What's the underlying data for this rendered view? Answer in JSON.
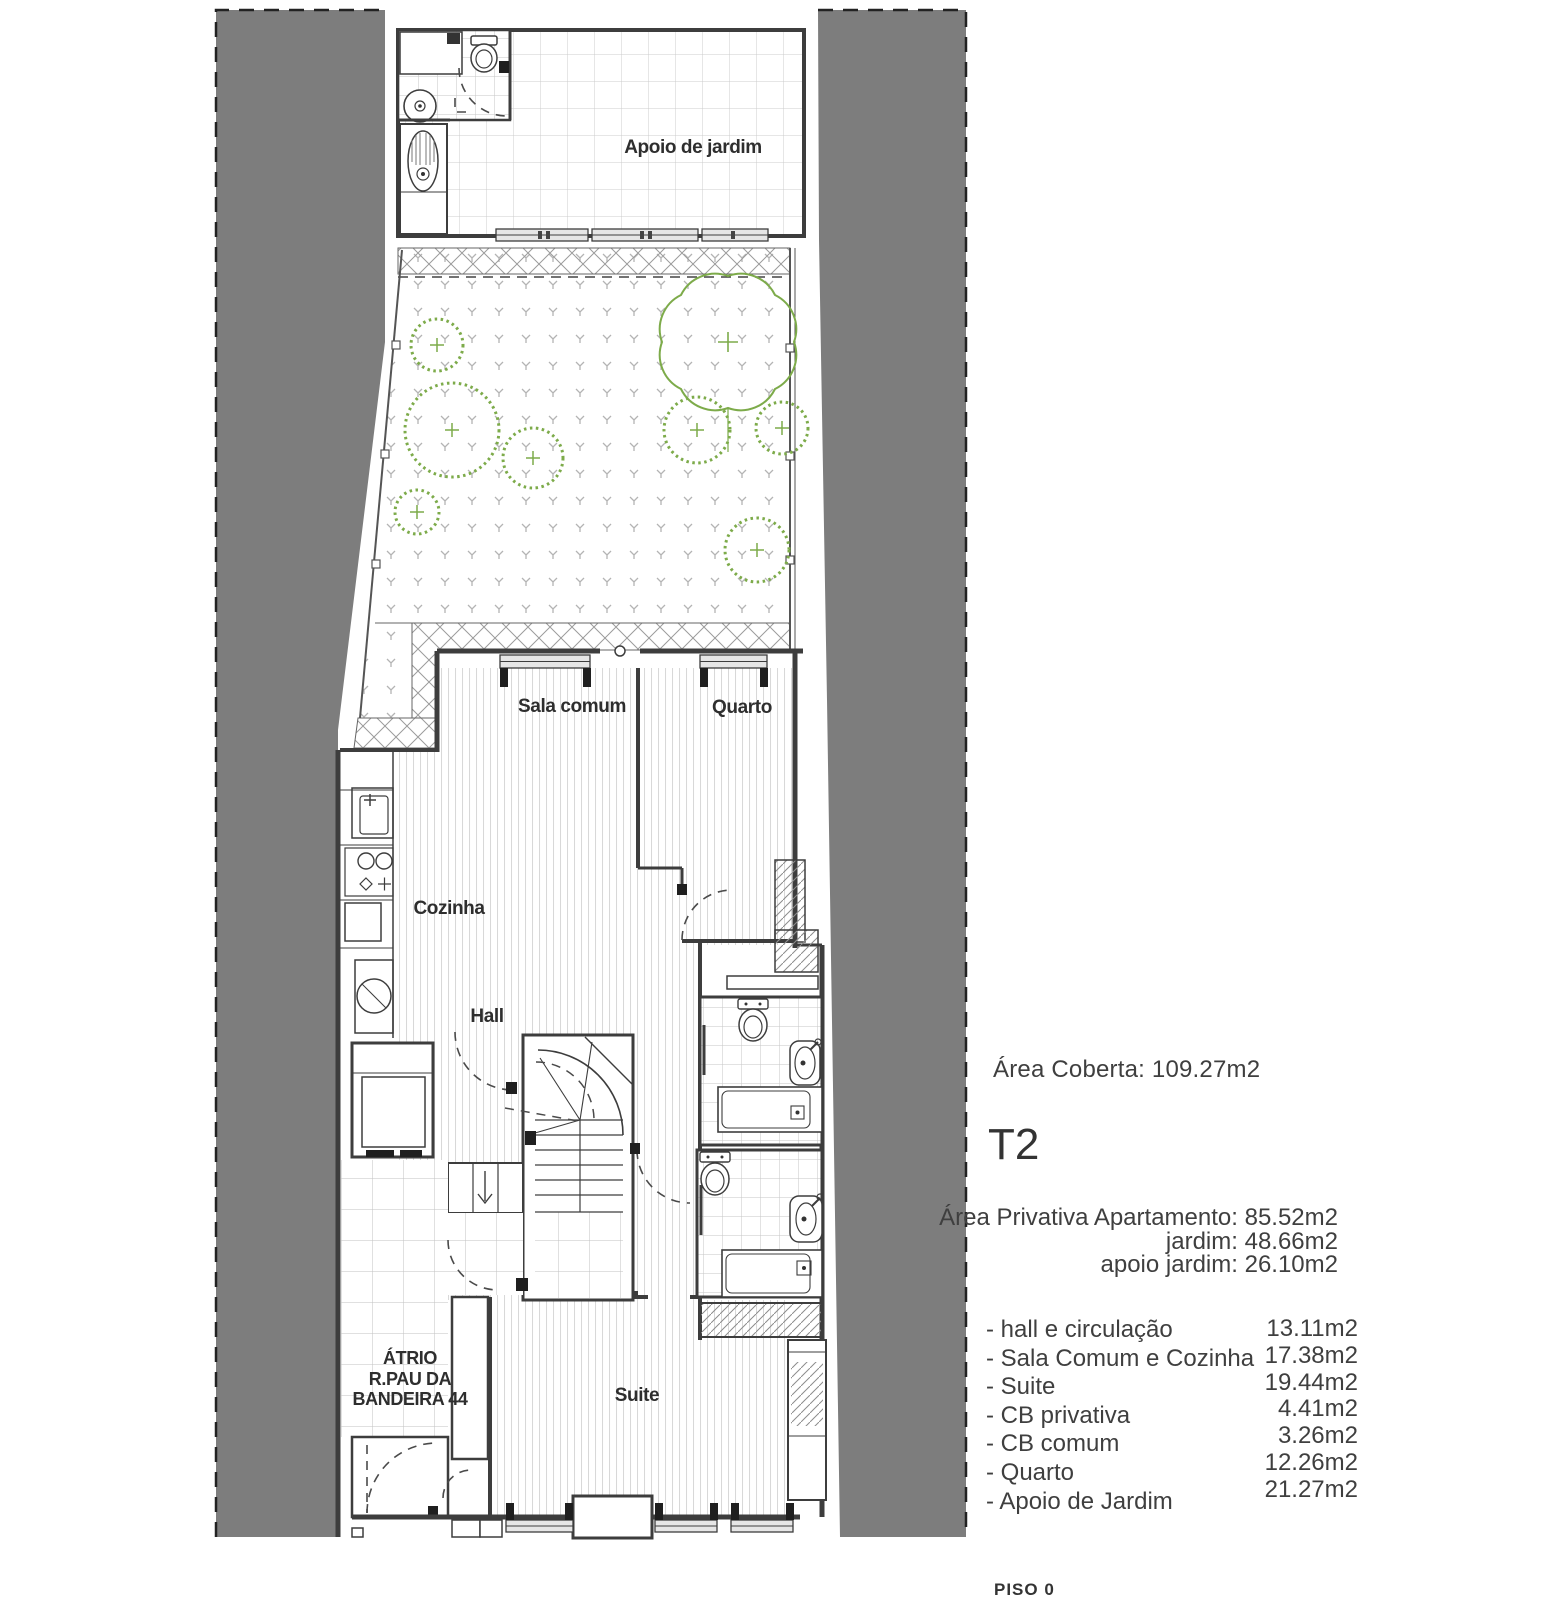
{
  "plan": {
    "rooms": {
      "apoio": "Apoio de jardim",
      "sala": "Sala comum",
      "quarto": "Quarto",
      "cozinha": "Cozinha",
      "hall": "Hall",
      "suite": "Suite",
      "atrio": {
        "line1": "ÁTRIO",
        "line2": "R.PAU DA",
        "line3": "BANDEIRA 44"
      }
    },
    "floor_label": "PISO 0"
  },
  "panel": {
    "area_coberta": {
      "label": "Área Coberta:",
      "value": "109.27m2"
    },
    "unit_type": "T2",
    "private_areas": [
      {
        "label": "Área Privativa Apartamento:",
        "value": "85.52m2"
      },
      {
        "label": "jardim:",
        "value": "48.66m2"
      },
      {
        "label": "apoio jardim:",
        "value": "26.10m2"
      }
    ],
    "room_areas": [
      {
        "label": "- hall e circulação",
        "value": "13.11m2"
      },
      {
        "label": "- Sala Comum e Cozinha",
        "value": "17.38m2"
      },
      {
        "label": "- Suite",
        "value": "19.44m2"
      },
      {
        "label": "- CB privativa",
        "value": "4.41m2"
      },
      {
        "label": "- CB comum",
        "value": "3.26m2"
      },
      {
        "label": "- Quarto",
        "value": "12.26m2"
      },
      {
        "label": "- Apoio de Jardim",
        "value": "21.27m2"
      }
    ]
  },
  "colors": {
    "neighbor_fill": "#7d7d7d",
    "vegetation": "#7dab4a",
    "wall_line": "#3d3d3d"
  }
}
